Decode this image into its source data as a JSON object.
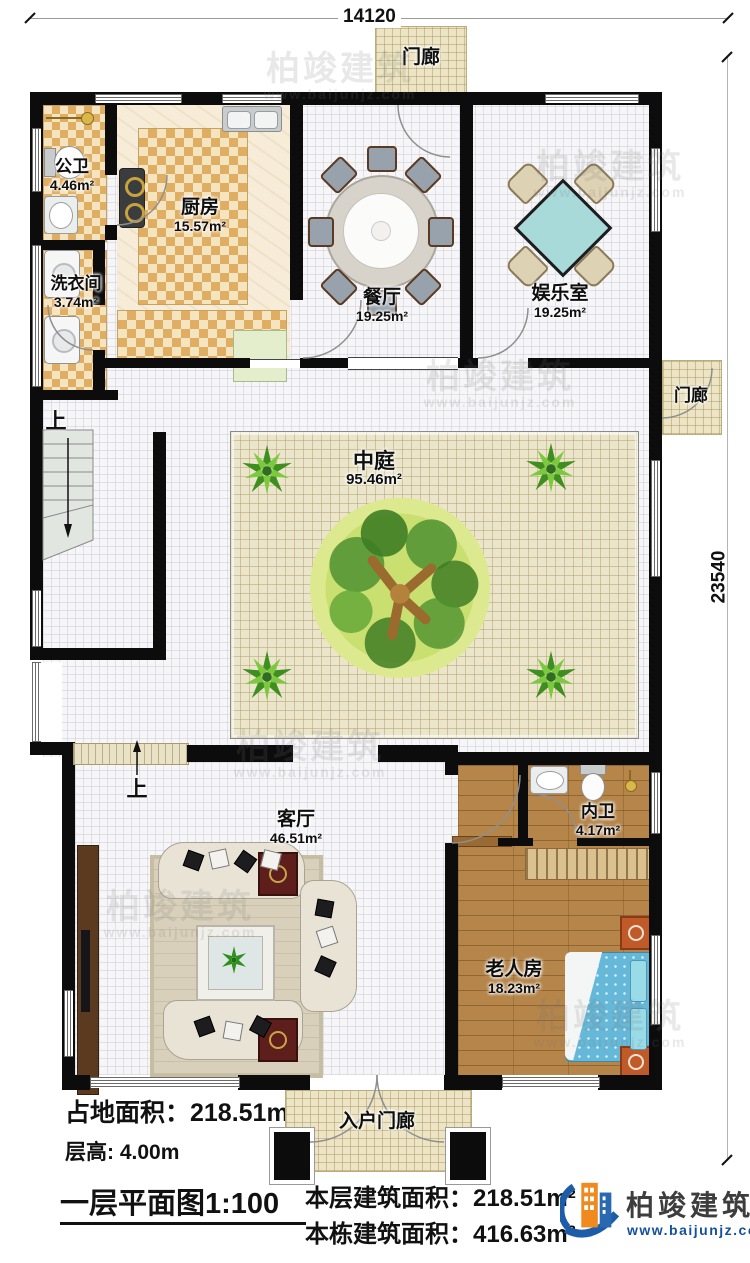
{
  "dimensions": {
    "width_label": "14120",
    "height_label": "23540"
  },
  "porches": {
    "top": "门廊",
    "side": "门廊",
    "entry": "入户门廊"
  },
  "stairs": {
    "up": "上"
  },
  "rooms": {
    "public_bath": {
      "name": "公卫",
      "area": "4.46m²"
    },
    "laundry": {
      "name": "洗衣间",
      "area": "3.74m²"
    },
    "kitchen": {
      "name": "厨房",
      "area": "15.57m²"
    },
    "dining": {
      "name": "餐厅",
      "area": "19.25m²"
    },
    "recreation": {
      "name": "娱乐室",
      "area": "19.25m²"
    },
    "courtyard": {
      "name": "中庭",
      "area": "95.46m²"
    },
    "living": {
      "name": "客厅",
      "area": "46.51m²"
    },
    "inner_bath": {
      "name": "内卫",
      "area": "4.17m²"
    },
    "elder_bedroom": {
      "name": "老人房",
      "area": "18.23m²"
    }
  },
  "footer": {
    "land_area": "占地面积：218.51m²",
    "floor_height": "层高: 4.00m",
    "plan_title": "一层平面图1:100",
    "floor_area": "本层建筑面积：218.51m²",
    "building_area": "本栋建筑面积：416.63m²"
  },
  "brand": {
    "name": "柏竣建筑",
    "url": "www.baijunjz.com"
  }
}
